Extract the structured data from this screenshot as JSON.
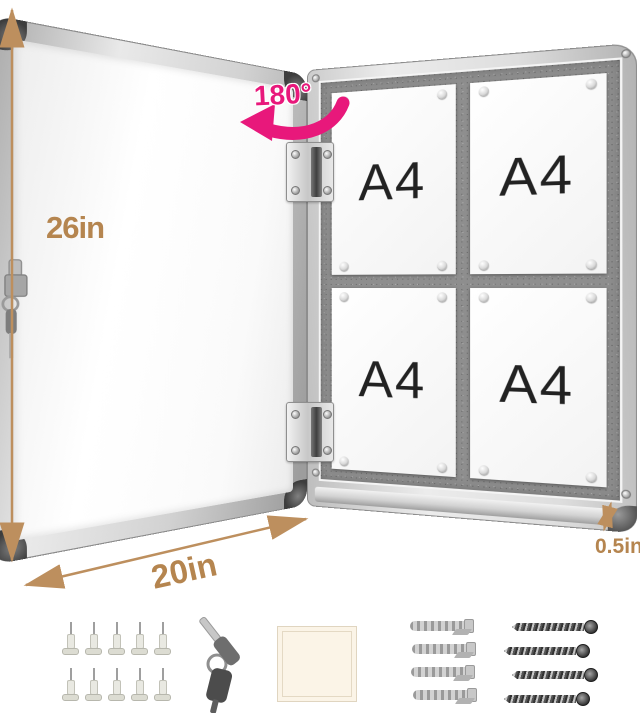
{
  "product": {
    "description": "Wall-mounted lockable notice board shown open with four A4 sheets pinned inside",
    "rotation_label": "180°",
    "dimensions": {
      "height": "26in",
      "width": "20in",
      "depth": "0.5in"
    },
    "board": {
      "papers": [
        "A4",
        "A4",
        "A4",
        "A4"
      ],
      "pins_per_paper": 4
    },
    "accessories": [
      {
        "name": "push-pins",
        "count": 10
      },
      {
        "name": "keys",
        "count": 2
      },
      {
        "name": "adhesive-pad",
        "count": 1
      },
      {
        "name": "wall-anchors",
        "count": 4
      },
      {
        "name": "screws",
        "count": 4
      }
    ],
    "colors": {
      "accent_pink": "#E8187B",
      "dimension_tan": "#B5854F",
      "felt_gray": "#8E8E8E",
      "aluminum": "#D9D9D9"
    }
  }
}
